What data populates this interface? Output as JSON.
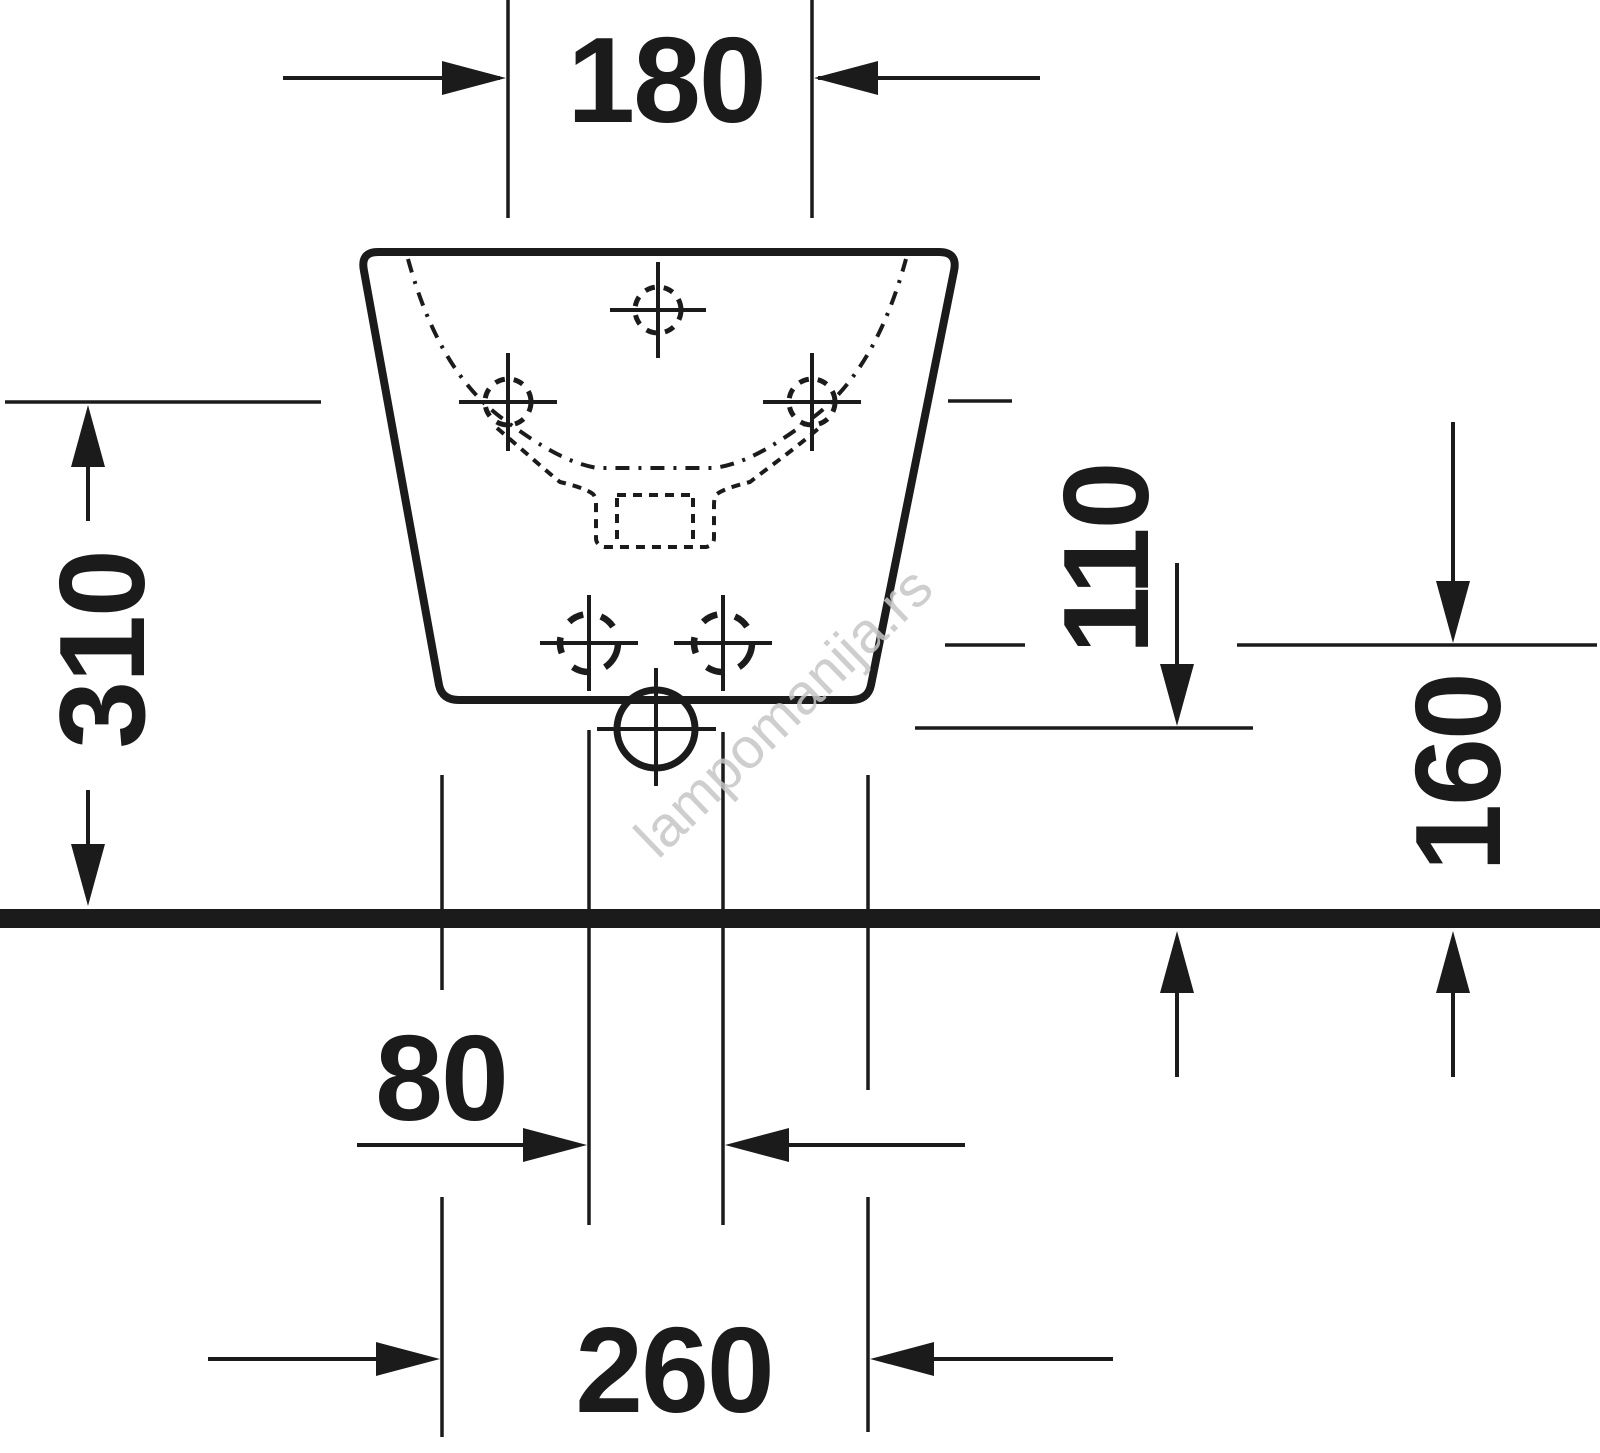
{
  "drawing": {
    "type": "technical-dimension-drawing",
    "subject": "wall-hung bidet, rear view with mounting and outlet dimensions",
    "units": "mm",
    "colors": {
      "background": "#ffffff",
      "line": "#1b1b1b",
      "watermark": "#c6c6c6"
    },
    "watermark": {
      "text": "lampomanija.rs"
    },
    "dimensions": [
      {
        "id": "side-fixing-hole-spacing",
        "value": "180",
        "orientation": "horizontal"
      },
      {
        "id": "side-fixing-hole-height",
        "value": "310",
        "orientation": "vertical"
      },
      {
        "id": "waste-outlet-height",
        "value": "110",
        "orientation": "vertical"
      },
      {
        "id": "lower-fixing-hole-height",
        "value": "160",
        "orientation": "vertical"
      },
      {
        "id": "lower-fixing-hole-spacing",
        "value": "80",
        "orientation": "horizontal"
      },
      {
        "id": "base-width",
        "value": "260",
        "orientation": "horizontal"
      }
    ]
  }
}
